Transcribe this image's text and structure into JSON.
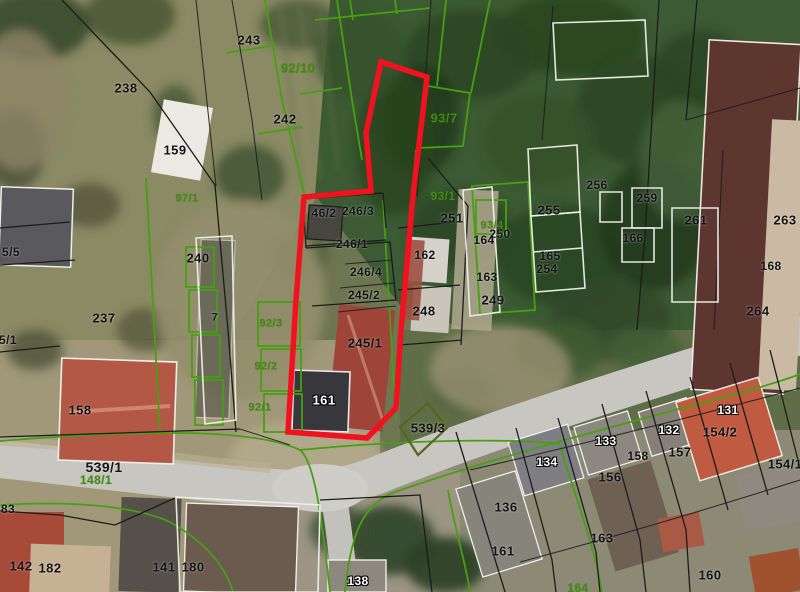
{
  "map": {
    "type": "cadastral-orthophoto",
    "highlight_note": "red outline marks selected parcel group 246/1, 245/1, 245/2, 246/4"
  },
  "colors": {
    "red-outline": "#f2111f",
    "green-line": "#46a012",
    "green-text": "#3f8e0e",
    "olive-line": "#56671d",
    "black-line": "#1c1c1c",
    "white-line": "#efefea",
    "road": "#c8c6c1"
  },
  "red_parcel": {
    "points": "381,62 427,77 413,196 401,330 396,408 367,438 288,432 296,300 304,197 371,191 366,133"
  },
  "labels": [
    {
      "t": "243",
      "x": 249,
      "y": 40,
      "c": "k",
      "s": 13
    },
    {
      "t": "238",
      "x": 126,
      "y": 88,
      "c": "k",
      "s": 13
    },
    {
      "t": "159",
      "x": 175,
      "y": 150,
      "c": "k",
      "s": 13
    },
    {
      "t": "92/10",
      "x": 298,
      "y": 68,
      "c": "g",
      "s": 13
    },
    {
      "t": "242",
      "x": 285,
      "y": 119,
      "c": "k",
      "s": 13
    },
    {
      "t": "93/7",
      "x": 444,
      "y": 118,
      "c": "g",
      "s": 13
    },
    {
      "t": "97/1",
      "x": 187,
      "y": 199,
      "c": "g",
      "s": 11
    },
    {
      "t": "93/1",
      "x": 443,
      "y": 196,
      "c": "g",
      "s": 12
    },
    {
      "t": "46/2",
      "x": 324,
      "y": 213,
      "c": "k",
      "s": 12
    },
    {
      "t": "246/3",
      "x": 358,
      "y": 211,
      "c": "k",
      "s": 12
    },
    {
      "t": "246/1",
      "x": 352,
      "y": 244,
      "c": "k",
      "s": 12
    },
    {
      "t": "251",
      "x": 452,
      "y": 218,
      "c": "k",
      "s": 13
    },
    {
      "t": "162",
      "x": 425,
      "y": 255,
      "c": "k",
      "s": 12
    },
    {
      "t": "246/4",
      "x": 366,
      "y": 272,
      "c": "k",
      "s": 12
    },
    {
      "t": "245/2",
      "x": 364,
      "y": 295,
      "c": "k",
      "s": 12
    },
    {
      "t": "248",
      "x": 424,
      "y": 311,
      "c": "k",
      "s": 13
    },
    {
      "t": "245/1",
      "x": 365,
      "y": 343,
      "c": "k",
      "s": 13
    },
    {
      "t": "240",
      "x": 198,
      "y": 258,
      "c": "k",
      "s": 13
    },
    {
      "t": "237",
      "x": 104,
      "y": 318,
      "c": "k",
      "s": 13
    },
    {
      "t": "5/5",
      "x": 11,
      "y": 252,
      "c": "k",
      "s": 12
    },
    {
      "t": "5/1",
      "x": 8,
      "y": 340,
      "c": "k",
      "s": 12
    },
    {
      "t": "7",
      "x": 215,
      "y": 318,
      "c": "k",
      "s": 11
    },
    {
      "t": "92/3",
      "x": 271,
      "y": 324,
      "c": "g",
      "s": 11
    },
    {
      "t": "92/2",
      "x": 266,
      "y": 367,
      "c": "g",
      "s": 11
    },
    {
      "t": "92/1",
      "x": 260,
      "y": 408,
      "c": "g",
      "s": 11
    },
    {
      "t": "158",
      "x": 80,
      "y": 410,
      "c": "k",
      "s": 13
    },
    {
      "t": "161",
      "x": 324,
      "y": 400,
      "c": "w",
      "s": 13
    },
    {
      "t": "539/3",
      "x": 428,
      "y": 428,
      "c": "k",
      "s": 13
    },
    {
      "t": "539/1",
      "x": 104,
      "y": 467,
      "c": "k",
      "s": 14
    },
    {
      "t": "148/1",
      "x": 96,
      "y": 480,
      "c": "g",
      "s": 12
    },
    {
      "t": "83",
      "x": 8,
      "y": 509,
      "c": "k",
      "s": 12
    },
    {
      "t": "142",
      "x": 21,
      "y": 566,
      "c": "k",
      "s": 13
    },
    {
      "t": "182",
      "x": 50,
      "y": 568,
      "c": "k",
      "s": 13
    },
    {
      "t": "141",
      "x": 164,
      "y": 567,
      "c": "k",
      "s": 13
    },
    {
      "t": "180",
      "x": 193,
      "y": 567,
      "c": "k",
      "s": 13
    },
    {
      "t": "138",
      "x": 358,
      "y": 581,
      "c": "w",
      "s": 12
    },
    {
      "t": "93/4",
      "x": 492,
      "y": 226,
      "c": "g",
      "s": 11
    },
    {
      "t": "250",
      "x": 500,
      "y": 234,
      "c": "k",
      "s": 12
    },
    {
      "t": "164",
      "x": 484,
      "y": 240,
      "c": "k",
      "s": 12
    },
    {
      "t": "163",
      "x": 487,
      "y": 277,
      "c": "k",
      "s": 12
    },
    {
      "t": "249",
      "x": 493,
      "y": 300,
      "c": "k",
      "s": 13
    },
    {
      "t": "255",
      "x": 549,
      "y": 210,
      "c": "k",
      "s": 13
    },
    {
      "t": "165",
      "x": 550,
      "y": 256,
      "c": "k",
      "s": 12
    },
    {
      "t": "254",
      "x": 547,
      "y": 269,
      "c": "k",
      "s": 12
    },
    {
      "t": "256",
      "x": 597,
      "y": 185,
      "c": "k",
      "s": 12
    },
    {
      "t": "259",
      "x": 647,
      "y": 198,
      "c": "k",
      "s": 12
    },
    {
      "t": "166",
      "x": 633,
      "y": 238,
      "c": "k",
      "s": 12
    },
    {
      "t": "261",
      "x": 696,
      "y": 220,
      "c": "k",
      "s": 13
    },
    {
      "t": "263",
      "x": 785,
      "y": 220,
      "c": "k",
      "s": 13
    },
    {
      "t": "168",
      "x": 771,
      "y": 266,
      "c": "k",
      "s": 12
    },
    {
      "t": "264",
      "x": 758,
      "y": 311,
      "c": "k",
      "s": 13
    },
    {
      "t": "134",
      "x": 547,
      "y": 462,
      "c": "w",
      "s": 12
    },
    {
      "t": "133",
      "x": 606,
      "y": 441,
      "c": "w",
      "s": 12
    },
    {
      "t": "132",
      "x": 669,
      "y": 430,
      "c": "w",
      "s": 12
    },
    {
      "t": "131",
      "x": 728,
      "y": 410,
      "c": "w",
      "s": 12
    },
    {
      "t": "154/2",
      "x": 720,
      "y": 432,
      "c": "k",
      "s": 13
    },
    {
      "t": "154/1",
      "x": 785,
      "y": 464,
      "c": "k",
      "s": 13
    },
    {
      "t": "156",
      "x": 610,
      "y": 477,
      "c": "k",
      "s": 13
    },
    {
      "t": "158",
      "x": 638,
      "y": 456,
      "c": "k",
      "s": 12
    },
    {
      "t": "157",
      "x": 680,
      "y": 452,
      "c": "k",
      "s": 13
    },
    {
      "t": "136",
      "x": 506,
      "y": 507,
      "c": "k",
      "s": 13
    },
    {
      "t": "161",
      "x": 503,
      "y": 551,
      "c": "k",
      "s": 13
    },
    {
      "t": "163",
      "x": 602,
      "y": 538,
      "c": "k",
      "s": 13
    },
    {
      "t": "160",
      "x": 710,
      "y": 575,
      "c": "k",
      "s": 13
    },
    {
      "t": "164",
      "x": 578,
      "y": 588,
      "c": "g",
      "s": 12
    }
  ]
}
